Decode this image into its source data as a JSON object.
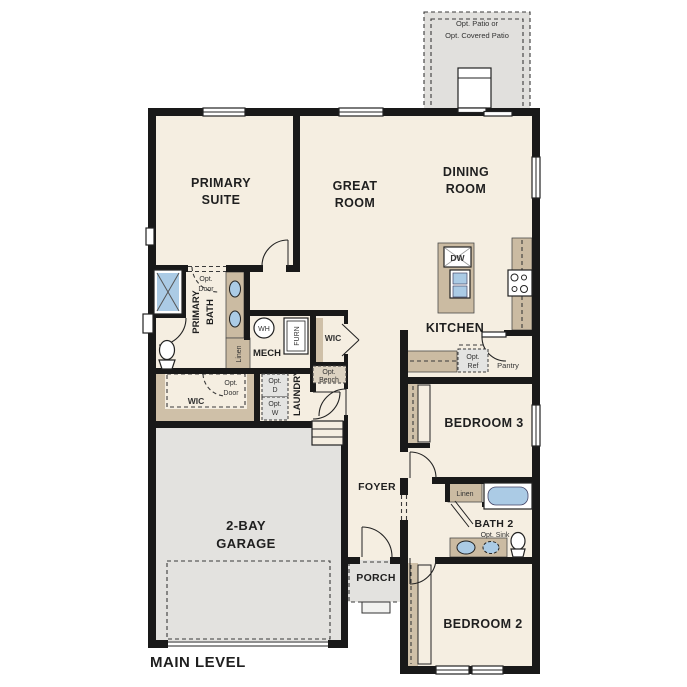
{
  "floor_label": "MAIN LEVEL",
  "patio": {
    "line1": "Opt. Patio or",
    "line2": "Opt. Covered Patio"
  },
  "rooms": {
    "primary_suite": {
      "l1": "PRIMARY",
      "l2": "SUITE"
    },
    "great_room": {
      "l1": "GREAT",
      "l2": "ROOM"
    },
    "dining_room": {
      "l1": "DINING",
      "l2": "ROOM"
    },
    "kitchen": "KITCHEN",
    "pantry": "Pantry",
    "primary_bath": {
      "l1": "PRIMARY",
      "l2": "BATH"
    },
    "mech": "MECH",
    "laundry": "LAUNDRY",
    "wic_primary": "WIC",
    "wic_hall": "WIC",
    "linen_primary": "Linen",
    "linen_bath2": "Linen",
    "bedroom3": "BEDROOM 3",
    "bath2": "BATH 2",
    "bedroom2": "BEDROOM 2",
    "foyer": "FOYER",
    "porch": "PORCH",
    "garage": {
      "l1": "2-BAY",
      "l2": "GARAGE"
    }
  },
  "fixtures": {
    "water_heater": "WH",
    "furnace": "FURN",
    "dishwasher": "DW"
  },
  "options": {
    "opt_door_bath": {
      "l1": "Opt.",
      "l2": "Door"
    },
    "opt_door_wic": {
      "l1": "Opt.",
      "l2": "Door"
    },
    "opt_ref": {
      "l1": "Opt.",
      "l2": "Ref"
    },
    "opt_dryer": {
      "l1": "Opt.",
      "l2": "D"
    },
    "opt_washer": {
      "l1": "Opt.",
      "l2": "W"
    },
    "opt_bench": {
      "l1": "Opt.",
      "l2": "Bench"
    },
    "opt_sink": "Opt. Sink"
  },
  "colors": {
    "floor": "#f5eee1",
    "garage": "#e3e2df",
    "counter_tan": "#cbbba2",
    "fixture_blue": "#abcbe5",
    "wall": "#191919",
    "patio_gray": "#e1e0dd"
  }
}
